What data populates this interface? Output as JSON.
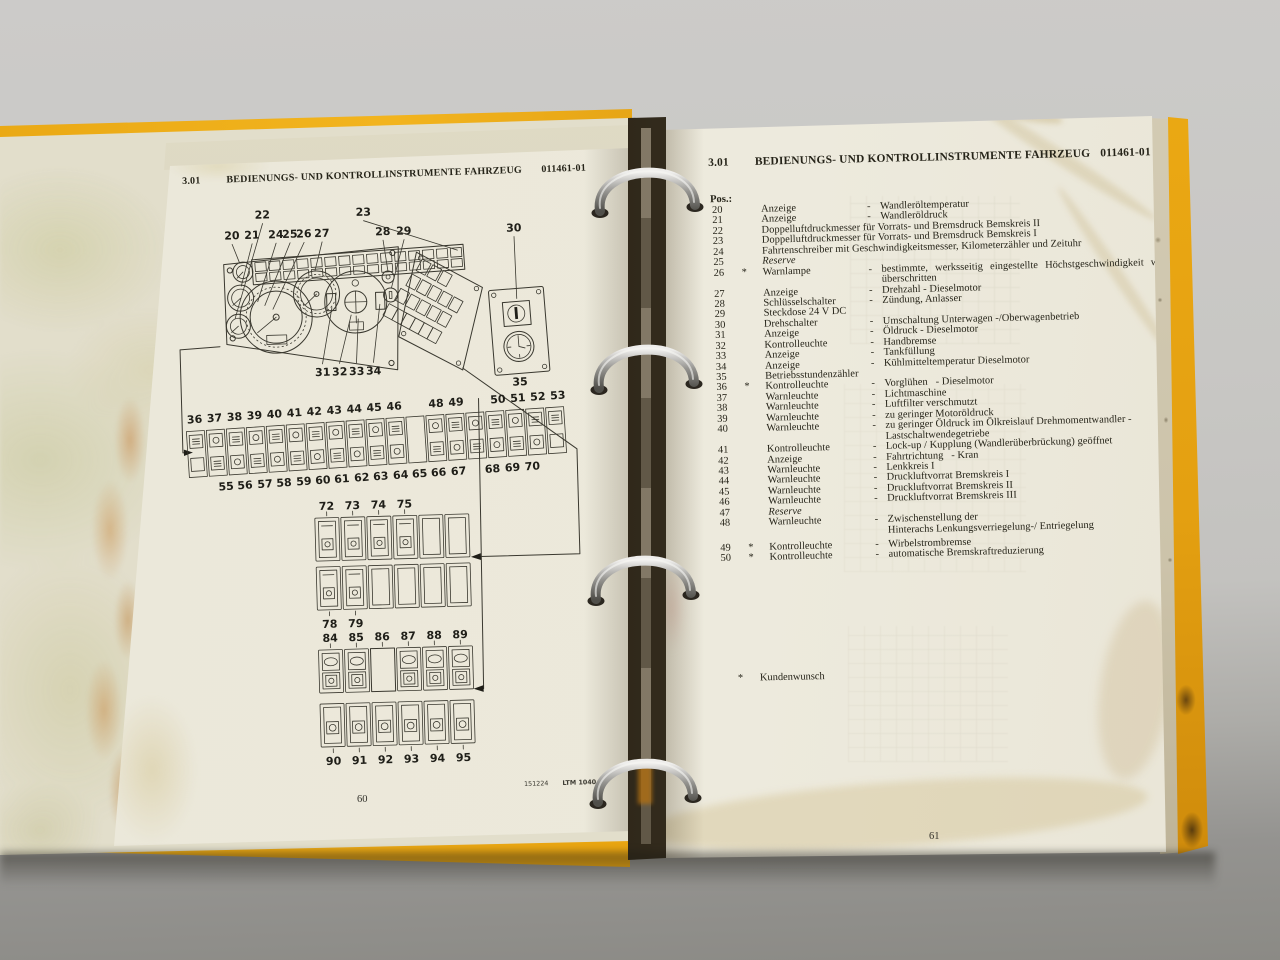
{
  "photo": {
    "binder_color": "#e7a713",
    "page_color": "#ece9dd",
    "background_color": "#c7c6c3"
  },
  "left_page": {
    "header": {
      "section": "3.01",
      "title": "BEDIENUNGS- UND KONTROLLINSTRUMENTE FAHRZEUG",
      "doc_id": "011461-01"
    },
    "diagram": {
      "top_callouts": [
        "20",
        "21",
        "22",
        "24",
        "25",
        "26",
        "27",
        "23",
        "28",
        "29",
        "30"
      ],
      "mid_callouts": [
        "31",
        "32",
        "33",
        "34"
      ],
      "clock_callout": "35",
      "strip_top": [
        "36",
        "37",
        "38",
        "39",
        "40",
        "41",
        "42",
        "43",
        "44",
        "45",
        "46",
        "48",
        "49",
        "50",
        "51",
        "52",
        "53"
      ],
      "strip_bottom": [
        "55",
        "56",
        "57",
        "58",
        "59",
        "60",
        "61",
        "62",
        "63",
        "64",
        "65",
        "66",
        "67",
        "68",
        "69",
        "70"
      ],
      "group1_labels": [
        "72",
        "73",
        "74",
        "75"
      ],
      "group2_labels": [
        "78",
        "79"
      ],
      "group3_labels": [
        "84",
        "85",
        "86",
        "87",
        "88",
        "89"
      ],
      "group4_labels": [
        "90",
        "91",
        "92",
        "93",
        "94",
        "95"
      ]
    },
    "footer": {
      "print_code": "151224",
      "model": "LTM 1040",
      "page_number": "60"
    }
  },
  "right_page": {
    "header": {
      "section": "3.01",
      "title": "BEDIENUNGS- UND KONTROLLINSTRUMENTE FAHRZEUG",
      "doc_id": "011461-01"
    },
    "list_label": "Pos.:",
    "items": [
      {
        "pos": "20",
        "star": "",
        "name": "Anzeige",
        "dash": "-",
        "desc": "Wandleröltemperatur"
      },
      {
        "pos": "21",
        "star": "",
        "name": "Anzeige",
        "dash": "-",
        "desc": "Wandleröldruck"
      },
      {
        "pos": "22",
        "star": "",
        "name": "Doppelluftdruckmesser für Vorrats- und Bremsdruck Bemskreis II",
        "dash": "",
        "desc": ""
      },
      {
        "pos": "23",
        "star": "",
        "name": "Doppelluftdruckmesser für Vorrats- und Bremsdruck Bemskreis I",
        "dash": "",
        "desc": ""
      },
      {
        "pos": "24",
        "star": "",
        "name": "Fahrtenschreiber mit Geschwindigkeitsmesser, Kilometerzähler und Zeituhr",
        "dash": "",
        "desc": ""
      },
      {
        "pos": "25",
        "star": "",
        "name": "Reserve",
        "dash": "",
        "desc": "",
        "class": "italic"
      },
      {
        "pos": "26",
        "star": "*",
        "name": "Warnlampe",
        "dash": "-",
        "desc": "bestimmte, werksseitig eingestellte Höchstgeschwindigkeit wird",
        "class": "spread"
      },
      {
        "pos": "",
        "star": "",
        "name": "",
        "dash": "",
        "desc": "überschritten"
      },
      {
        "pos": "27",
        "star": "",
        "name": "Anzeige",
        "dash": "-",
        "desc": "Drehzahl - Dieselmotor"
      },
      {
        "pos": "28",
        "star": "",
        "name": "Schlüsselschalter",
        "dash": "-",
        "desc": "Zündung, Anlasser"
      },
      {
        "pos": "29",
        "star": "",
        "name": "Steckdose 24 V DC",
        "dash": "",
        "desc": ""
      },
      {
        "pos": "30",
        "star": "",
        "name": "Drehschalter",
        "dash": "-",
        "desc": "Umschaltung Unterwagen -/Oberwagenbetrieb"
      },
      {
        "pos": "31",
        "star": "",
        "name": "Anzeige",
        "dash": "-",
        "desc": "Öldruck - Dieselmotor"
      },
      {
        "pos": "32",
        "star": "",
        "name": "Kontrolleuchte",
        "dash": "-",
        "desc": "Handbremse"
      },
      {
        "pos": "33",
        "star": "",
        "name": "Anzeige",
        "dash": "-",
        "desc": "Tankfüllung"
      },
      {
        "pos": "34",
        "star": "",
        "name": "Anzeige",
        "dash": "-",
        "desc": "Kühlmitteltemperatur Dieselmotor"
      },
      {
        "pos": "35",
        "star": "",
        "name": "Betriebsstundenzähler",
        "dash": "",
        "desc": ""
      },
      {
        "pos": "36",
        "star": "*",
        "name": "Kontrolleuchte",
        "dash": "-",
        "desc": "Vorglühen   - Dieselmotor"
      },
      {
        "pos": "37",
        "star": "",
        "name": "Warnleuchte",
        "dash": "-",
        "desc": "Lichtmaschine"
      },
      {
        "pos": "38",
        "star": "",
        "name": "Warnleuchte",
        "dash": "-",
        "desc": "Luftfilter verschmutzt"
      },
      {
        "pos": "39",
        "star": "",
        "name": "Warnleuchte",
        "dash": "-",
        "desc": "zu geringer Motoröldruck"
      },
      {
        "pos": "40",
        "star": "",
        "name": "Warnleuchte",
        "dash": "-",
        "desc": "zu geringer Öldruck im Ölkreislauf Drehmomentwandler -"
      },
      {
        "pos": "",
        "star": "",
        "name": "",
        "dash": "",
        "desc": "Lastschaltwendegetriebe"
      },
      {
        "pos": "41",
        "star": "",
        "name": "Kontrolleuchte",
        "dash": "-",
        "desc": "Lock-up / Kupplung (Wandlerüberbrückung) geöffnet"
      },
      {
        "pos": "42",
        "star": "",
        "name": "Anzeige",
        "dash": "-",
        "desc": "Fahrtrichtung   - Kran"
      },
      {
        "pos": "43",
        "star": "",
        "name": "Warnleuchte",
        "dash": "-",
        "desc": "Lenkkreis I"
      },
      {
        "pos": "44",
        "star": "",
        "name": "Warnleuchte",
        "dash": "-",
        "desc": "Druckluftvorrat Bremskreis I"
      },
      {
        "pos": "45",
        "star": "",
        "name": "Warnleuchte",
        "dash": "-",
        "desc": "Druckluftvorrat Bremskreis II"
      },
      {
        "pos": "46",
        "star": "",
        "name": "Warnleuchte",
        "dash": "-",
        "desc": "Druckluftvorrat Bremskreis III"
      },
      {
        "pos": "47",
        "star": "",
        "name": "Reserve",
        "dash": "",
        "desc": "",
        "class": "italic"
      },
      {
        "pos": "48",
        "star": "",
        "name": "Warnleuchte",
        "dash": "-",
        "desc": "Zwischenstellung der"
      },
      {
        "pos": "",
        "star": "",
        "name": "",
        "dash": "",
        "desc": "Hinterachs Lenkungsverriegelung-/ Entriegelung"
      },
      {
        "pos": "49",
        "star": "*",
        "name": "Kontrolleuchte",
        "dash": "-",
        "desc": "Wirbelstrombremse",
        "class": "gap"
      },
      {
        "pos": "50",
        "star": "*",
        "name": "Kontrolleuchte",
        "dash": "-",
        "desc": "automatische Bremskraftreduzierung"
      }
    ],
    "footnote": {
      "star": "*",
      "text": "Kundenwunsch"
    },
    "page_number": "61"
  }
}
